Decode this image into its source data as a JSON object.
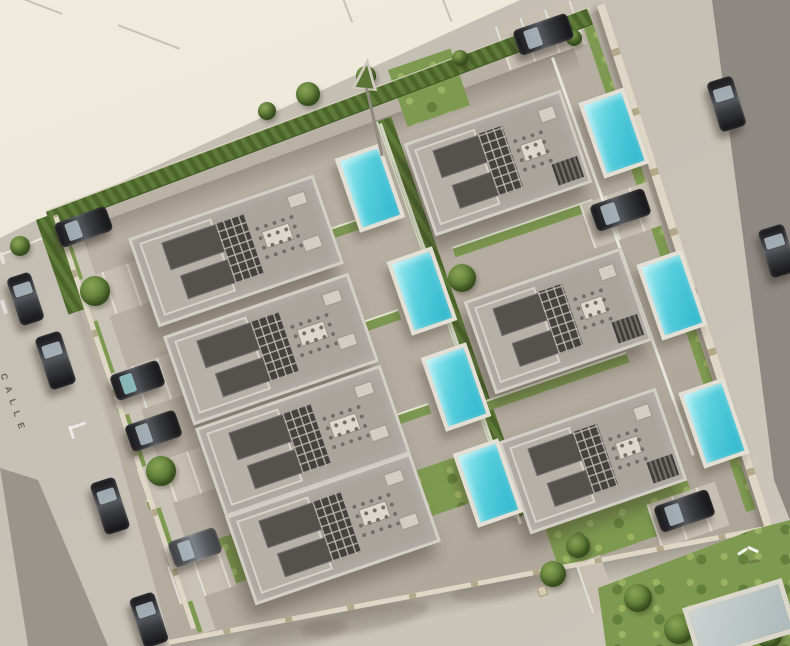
{
  "scene": {
    "type": "aerial-3d-architectural-render",
    "description": "Bird's-eye render of a walled residential compound with seven flat-roof villas, rooftop terraces, private pools, lawns and surrounding streets",
    "street_label": "CALLE"
  },
  "palette": {
    "road": "#c5bfb4",
    "empty_lot": "#ece6da",
    "asphalt_strip": "#8e8882",
    "compound_pavement": "#b6aea1",
    "perimeter_wall": "#ded7c6",
    "hedge": "#54702f",
    "lawn": "#7e9a50",
    "villa_roof": "#a9a49c",
    "villa_parapet": "#d3cec6",
    "pool_water": "#3fc2d6",
    "pool_deck": "#e4dfd4",
    "car_dark": "#2c2c30"
  },
  "inventory": {
    "villas": 7,
    "private_pools": 7,
    "parked_cars": 13,
    "extras": [
      "utility-pole",
      "flying-bird",
      "neighbor-pool"
    ]
  }
}
